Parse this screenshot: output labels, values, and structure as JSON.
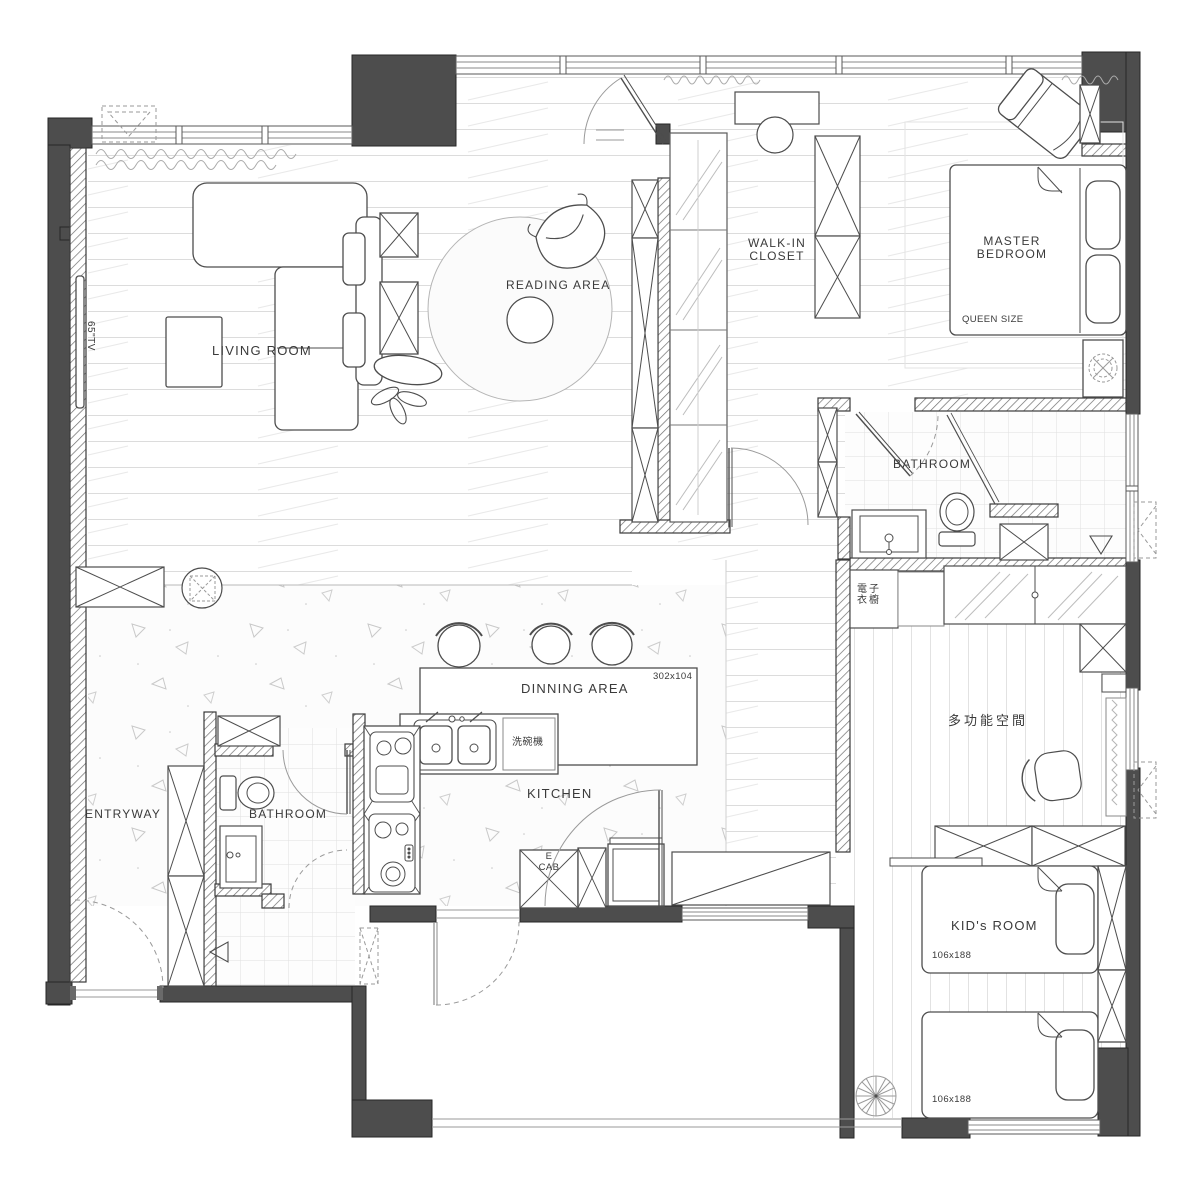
{
  "plan": {
    "title": "Apartment floor plan",
    "rooms": {
      "living_room": {
        "label": "LIVING ROOM"
      },
      "tv": {
        "label": "65\"TV"
      },
      "reading_area": {
        "label": "READING AREA"
      },
      "walk_in_closet": {
        "label_line1": "WALK-IN",
        "label_line2": "CLOSET"
      },
      "master_bedroom": {
        "label_line1": "MASTER",
        "label_line2": "BEDROOM",
        "bed_size": "QUEEN SIZE"
      },
      "master_bathroom": {
        "label": "BATHROOM"
      },
      "electronic_wardrobe": {
        "label_line1": "電子",
        "label_line2": "衣櫥"
      },
      "multipurpose_room": {
        "label": "多功能空間"
      },
      "kids_room": {
        "label": "KID's ROOM",
        "bed1_size": "106x188",
        "bed2_size": "106x188"
      },
      "dining_area": {
        "label": "DINNING AREA",
        "table_size": "302x104"
      },
      "kitchen": {
        "label": "KITCHEN",
        "dishwasher": "洗碗機",
        "cabinet_line1": "E",
        "cabinet_line2": "CAB"
      },
      "guest_bathroom": {
        "label": "BATHROOM"
      },
      "entryway": {
        "label": "ENTRYWAY"
      }
    },
    "colors": {
      "wall": "#4d4d4d",
      "line": "#3f3f3f",
      "floor_line": "#dcdcdc"
    }
  }
}
